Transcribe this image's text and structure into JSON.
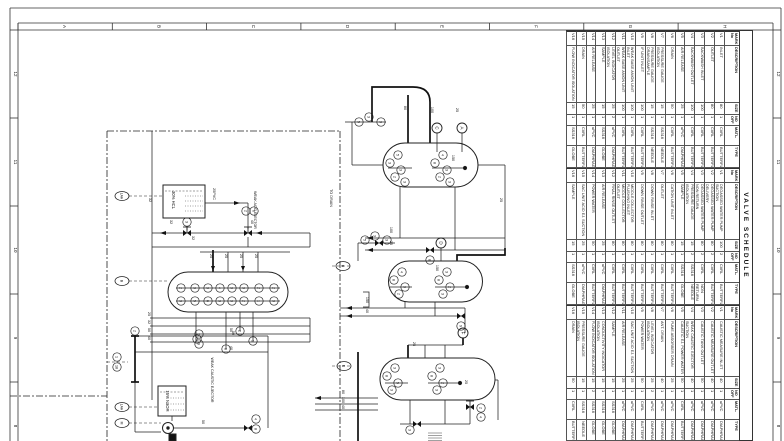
{
  "sheet": {
    "grid_letters": [
      "A",
      "B",
      "C",
      "D",
      "E",
      "F",
      "G",
      "H"
    ],
    "grid_numbers": [
      "12",
      "11",
      "10",
      "9",
      "8"
    ],
    "line_color": "#333333",
    "paper_color": "#ffffff"
  },
  "valve_schedule": {
    "title": "VALVE SCHEDULE",
    "columns": [
      "MARK No",
      "DESCRIPTION",
      "SIZE",
      "NO OFF",
      "MATL.",
      "TYPE"
    ],
    "groups": [
      {
        "rows": [
          {
            "mark": "V1",
            "desc": "INLET",
            "size": "80",
            "no": "1",
            "matl": "CI/RL",
            "type": "BUTTERFLY"
          },
          {
            "mark": "V2",
            "desc": "OUTLET",
            "size": "80",
            "no": "1",
            "matl": "CI/RL",
            "type": "BUTTERFLY"
          },
          {
            "mark": "V3",
            "desc": "BACKWASH INLET",
            "size": "100",
            "no": "1",
            "matl": "CI/RL",
            "type": "BUTTERFLY"
          },
          {
            "mark": "V4",
            "desc": "BACKWASH OUTLET",
            "size": "100",
            "no": "1",
            "matl": "CI/RL",
            "type": "BUTTERFLY"
          },
          {
            "mark": "V5",
            "desc": "AIR RELEASE",
            "size": "25",
            "no": "1",
            "matl": "uPVC",
            "type": "DIAPHRAGM"
          },
          {
            "mark": "V6",
            "desc": "DRAIN",
            "size": "50",
            "no": "1",
            "matl": "CI/RL",
            "type": "BUTTERFLY"
          },
          {
            "mark": "V7",
            "desc": "PRESSURE GAUGE ISOLATION",
            "size": "15",
            "no": "1",
            "matl": "SS316",
            "type": "NEEDLE"
          },
          {
            "mark": "V8",
            "desc": "PRESSURE GAUGE DRAIN/SAMPLE",
            "size": "15",
            "no": "1",
            "matl": "SS316",
            "type": "NEEDLE"
          },
          {
            "mark": "V9",
            "desc": "IF UNIT INLET",
            "size": "100",
            "no": "1",
            "matl": "CI/RL",
            "type": "BUTTERFLY"
          },
          {
            "mark": "V10",
            "desc": "WEAK BASE ANION UNIT INLET",
            "size": "100",
            "no": "1",
            "matl": "CI/RL",
            "type": "BUTTERFLY"
          },
          {
            "mark": "V11",
            "desc": "WEAK BASE ANION UNIT OUTLET",
            "size": "100",
            "no": "1",
            "matl": "CI/RL",
            "type": "BUTTERFLY"
          },
          {
            "mark": "V12",
            "desc": "LEVEL INDICATOR ISOLATION",
            "size": "25",
            "no": "2",
            "matl": "uPVC",
            "type": "DIAPHRAGM"
          },
          {
            "mark": "V13",
            "desc": "SAMPLE",
            "size": "15",
            "no": "1",
            "matl": "SS316",
            "type": "GLOBE"
          },
          {
            "mark": "V14",
            "desc": "AIR RELEASE",
            "size": "25",
            "no": "1",
            "matl": "uPVC",
            "type": "DIAPHRAGM"
          },
          {
            "mark": "V15",
            "desc": "DRAIN",
            "size": "50",
            "no": "1",
            "matl": "CI/RL",
            "type": "BUTTERFLY"
          },
          {
            "mark": "V16",
            "desc": "FLOW INDICATOR ISOLATION",
            "size": "15",
            "no": "1",
            "matl": "SS316",
            "type": "GLOBE"
          }
        ]
      },
      {
        "rows": [
          {
            "mark": "V1",
            "desc": "DEGASSED WATER PUMP SUCTION",
            "size": "100",
            "no": "2",
            "matl": "CI/RL",
            "type": "BUTTERFLY"
          },
          {
            "mark": "V2",
            "desc": "DEGASSED WATER PUMP DELIVERY",
            "size": "80",
            "no": "2",
            "matl": "CI/RL",
            "type": "BUTTERFLY"
          },
          {
            "mark": "V3",
            "desc": "DEGASSED WATER PUMP NON RETURN",
            "size": "80",
            "no": "2",
            "matl": "CI/RL",
            "type": "NON RETURN"
          },
          {
            "mark": "V4",
            "desc": "PRESSURE GAUGE ISOLATION",
            "size": "15",
            "no": "2",
            "matl": "SS316",
            "type": "NEEDLE"
          },
          {
            "mark": "V5",
            "desc": "SAMPLE",
            "size": "15",
            "no": "1",
            "matl": "SS316",
            "type": "GLOBE"
          },
          {
            "mark": "V6",
            "desc": "CATION UNIT INLET",
            "size": "80",
            "no": "1",
            "matl": "CI/RL",
            "type": "BUTTERFLY"
          },
          {
            "mark": "V7",
            "desc": "OUTLET",
            "size": "80",
            "no": "1",
            "matl": "CI/RL",
            "type": "BUTTERFLY"
          },
          {
            "mark": "V8",
            "desc": "DOWN RINSE INLET",
            "size": "80",
            "no": "1",
            "matl": "CI/RL",
            "type": "BUTTERFLY"
          },
          {
            "mark": "V9",
            "desc": "DOWN RINSE OUTLET",
            "size": "80",
            "no": "1",
            "matl": "CI/RL",
            "type": "BUTTERFLY"
          },
          {
            "mark": "V10",
            "desc": "MIDDLE COLLECTOR FLUSHING INLET",
            "size": "80",
            "no": "1",
            "matl": "CI/RL",
            "type": "BUTTERFLY"
          },
          {
            "mark": "V11",
            "desc": "MIDDLE COLLECTOR OUTLET",
            "size": "80",
            "no": "1",
            "matl": "CI/RL",
            "type": "BUTTERFLY"
          },
          {
            "mark": "V12",
            "desc": "FINAL RINSE OUTLET",
            "size": "80",
            "no": "1",
            "matl": "CI/RL",
            "type": "BUTTERFLY"
          },
          {
            "mark": "V13",
            "desc": "AIR RELEASE",
            "size": "25",
            "no": "1",
            "matl": "uPVC",
            "type": "DIAPHRAGM"
          },
          {
            "mark": "V14",
            "desc": "POWER WATER",
            "size": "50",
            "no": "1",
            "matl": "CI/RL",
            "type": "BUTTERFLY"
          },
          {
            "mark": "V15",
            "desc": "SAC UNIT ACID EJ. SUCTION",
            "size": "25",
            "no": "1",
            "matl": "uPVC",
            "type": "DIAPHRAGM"
          },
          {
            "mark": "V16",
            "desc": "SAMPLE",
            "size": "15",
            "no": "1",
            "matl": "SS316",
            "type": "GLOBE"
          }
        ]
      },
      {
        "rows": [
          {
            "mark": "V1",
            "desc": "CAUSTIC MEASURE INLET",
            "size": "40",
            "no": "1",
            "matl": "uPVC",
            "type": "DIAPHRAGM"
          },
          {
            "mark": "V2",
            "desc": "CAUSTIC MEASURE OUTLET",
            "size": "40",
            "no": "1",
            "matl": "uPVC",
            "type": "DIAPHRAGM"
          },
          {
            "mark": "V3",
            "desc": "CAUSTIC TANK OUTLET",
            "size": "50",
            "no": "1",
            "matl": "uPVC",
            "type": "DIAPHRAGM"
          },
          {
            "mark": "V4",
            "desc": "WEAK CAUSTIC EJECTOR SUCTION",
            "size": "40",
            "no": "1",
            "matl": "uPVC",
            "type": "DIAPHRAGM"
          },
          {
            "mark": "V5",
            "desc": "CAUSTIC EJ. POWER WATER",
            "size": "50",
            "no": "1",
            "matl": "CI/RL",
            "type": "BUTTERFLY"
          },
          {
            "mark": "V6",
            "desc": "FUME ABSORBER DRAIN",
            "size": "25",
            "no": "1",
            "matl": "uPVC",
            "type": "DIAPHRAGM"
          },
          {
            "mark": "V7",
            "desc": "ANT. DRAIN",
            "size": "40",
            "no": "1",
            "matl": "uPVC",
            "type": "DIAPHRAGM"
          },
          {
            "mark": "V8",
            "desc": "LEVEL INDICATOR ISOLATION",
            "size": "25",
            "no": "2",
            "matl": "uPVC",
            "type": "DIAPHRAGM"
          },
          {
            "mark": "V9",
            "desc": "POWER WATER",
            "size": "50",
            "no": "1",
            "matl": "CI/RL",
            "type": "BUTTERFLY"
          },
          {
            "mark": "V10",
            "desc": "SAC UNIT ACID EJ. SUCTION",
            "size": "25",
            "no": "1",
            "matl": "uPVC",
            "type": "DIAPHRAGM"
          },
          {
            "mark": "V11",
            "desc": "AIR RELEASE",
            "size": "25",
            "no": "1",
            "matl": "uPVC",
            "type": "DIAPHRAGM"
          },
          {
            "mark": "V12",
            "desc": "SAMPLE",
            "size": "15",
            "no": "1",
            "matl": "SS316",
            "type": "GLOBE"
          },
          {
            "mark": "V13",
            "desc": "CONDUCTIVITY INDICATOR ISOLATION",
            "size": "15",
            "no": "1",
            "matl": "SS316",
            "type": "GLOBE"
          },
          {
            "mark": "V14",
            "desc": "FLOW INDICATOR ISOLATION",
            "size": "15",
            "no": "2",
            "matl": "SS316",
            "type": "GLOBE"
          },
          {
            "mark": "V15",
            "desc": "PRESSURE GAUGE ISOLATION",
            "size": "15",
            "no": "1",
            "matl": "SS316",
            "type": "NEEDLE"
          },
          {
            "mark": "V16",
            "desc": "DRAIN",
            "size": "50",
            "no": "1",
            "matl": "CI/RL",
            "type": "BUTTERFLY"
          }
        ]
      }
    ]
  },
  "diagram": {
    "equipment": {
      "acid_tank": "30% HCL",
      "caustic_tank": "15% NaOH",
      "acid_ejector": "WEAK ACID EJECTOR",
      "caustic_ejector": "WEAK CAUSTIC EJECTOR",
      "to_drain": "TO DRAIN",
      "scope_note": "SCOPE OF CONTRACT"
    },
    "connectors": [
      {
        "x": 437,
        "y": 128,
        "t": "C"
      },
      {
        "x": 462,
        "y": 128,
        "t": "A"
      },
      {
        "x": 441,
        "y": 243,
        "t": "D"
      },
      {
        "x": 463,
        "y": 333,
        "t": "F"
      }
    ],
    "ovals": [
      {
        "x": 122,
        "y": 196,
        "t": "LAH"
      },
      {
        "x": 122,
        "y": 281,
        "t": "B"
      },
      {
        "x": 343,
        "y": 266,
        "t": "B"
      },
      {
        "x": 344,
        "y": 366,
        "t": "E"
      },
      {
        "x": 122,
        "y": 407,
        "t": "LAH"
      },
      {
        "x": 122,
        "y": 423,
        "t": "M"
      }
    ],
    "pipe_labels": [
      {
        "x": 213,
        "y": 194,
        "t": "25PVC"
      },
      {
        "x": 170,
        "y": 222,
        "t": "32"
      },
      {
        "x": 251,
        "y": 222,
        "t": "40"
      },
      {
        "x": 192,
        "y": 238,
        "t": "32"
      },
      {
        "x": 210,
        "y": 256,
        "t": "25"
      },
      {
        "x": 225,
        "y": 256,
        "t": "25"
      },
      {
        "x": 240,
        "y": 256,
        "t": "25"
      },
      {
        "x": 255,
        "y": 256,
        "t": "25"
      },
      {
        "x": 148,
        "y": 314,
        "t": "25"
      },
      {
        "x": 148,
        "y": 322,
        "t": "32"
      },
      {
        "x": 148,
        "y": 330,
        "t": "50"
      },
      {
        "x": 148,
        "y": 338,
        "t": "40"
      },
      {
        "x": 230,
        "y": 330,
        "t": "50"
      },
      {
        "x": 230,
        "y": 348,
        "t": "40"
      },
      {
        "x": 202,
        "y": 422,
        "t": "50"
      },
      {
        "x": 390,
        "y": 230,
        "t": "100"
      },
      {
        "x": 390,
        "y": 243,
        "t": "25"
      },
      {
        "x": 431,
        "y": 110,
        "t": "100"
      },
      {
        "x": 456,
        "y": 110,
        "t": "25"
      },
      {
        "x": 404,
        "y": 108,
        "t": "80"
      },
      {
        "x": 500,
        "y": 200,
        "t": "25"
      },
      {
        "x": 452,
        "y": 158,
        "t": "150"
      },
      {
        "x": 436,
        "y": 268,
        "t": "150"
      },
      {
        "x": 366,
        "y": 300,
        "t": "150"
      },
      {
        "x": 366,
        "y": 311,
        "t": "40"
      },
      {
        "x": 342,
        "y": 392,
        "t": "80"
      },
      {
        "x": 342,
        "y": 400,
        "t": "100"
      },
      {
        "x": 342,
        "y": 407,
        "t": "40"
      },
      {
        "x": 413,
        "y": 344,
        "t": "25"
      },
      {
        "x": 232,
        "y": 333,
        "t": "50"
      },
      {
        "x": 465,
        "y": 382,
        "t": "25"
      },
      {
        "x": 149,
        "y": 200,
        "t": "32"
      }
    ],
    "valve_tags": [
      {
        "x": 187,
        "y": 222,
        "t": "3"
      },
      {
        "x": 246,
        "y": 211,
        "t": "2"
      },
      {
        "x": 254,
        "y": 211,
        "t": "6"
      },
      {
        "x": 117,
        "y": 357,
        "t": "1"
      },
      {
        "x": 117,
        "y": 367,
        "t": "18"
      },
      {
        "x": 199,
        "y": 334,
        "t": "7"
      },
      {
        "x": 199,
        "y": 344,
        "t": "9"
      },
      {
        "x": 256,
        "y": 419,
        "t": "4"
      },
      {
        "x": 256,
        "y": 429,
        "t": "8"
      },
      {
        "x": 135,
        "y": 331,
        "t": "2"
      },
      {
        "x": 197,
        "y": 339,
        "t": "5"
      },
      {
        "x": 240,
        "y": 331,
        "t": "2"
      },
      {
        "x": 253,
        "y": 341,
        "t": "3"
      },
      {
        "x": 226,
        "y": 349,
        "t": "8"
      },
      {
        "x": 181,
        "y": 288,
        "t": "2"
      },
      {
        "x": 195,
        "y": 288,
        "t": "3"
      },
      {
        "x": 208,
        "y": 288,
        "t": "3"
      },
      {
        "x": 220,
        "y": 288,
        "t": "4"
      },
      {
        "x": 232,
        "y": 288,
        "t": "3"
      },
      {
        "x": 244,
        "y": 288,
        "t": "3"
      },
      {
        "x": 259,
        "y": 288,
        "t": "2"
      },
      {
        "x": 274,
        "y": 288,
        "t": "2"
      },
      {
        "x": 181,
        "y": 301,
        "t": "3"
      },
      {
        "x": 195,
        "y": 301,
        "t": "5"
      },
      {
        "x": 208,
        "y": 301,
        "t": "6"
      },
      {
        "x": 220,
        "y": 301,
        "t": "3"
      },
      {
        "x": 232,
        "y": 301,
        "t": "3"
      },
      {
        "x": 244,
        "y": 301,
        "t": "2"
      },
      {
        "x": 259,
        "y": 301,
        "t": "1"
      },
      {
        "x": 274,
        "y": 301,
        "t": "3"
      },
      {
        "x": 359,
        "y": 122,
        "t": "5"
      },
      {
        "x": 369,
        "y": 117,
        "t": "3"
      },
      {
        "x": 381,
        "y": 122,
        "t": "3"
      },
      {
        "x": 365,
        "y": 240,
        "t": "5"
      },
      {
        "x": 375,
        "y": 236,
        "t": "3"
      },
      {
        "x": 387,
        "y": 240,
        "t": "3"
      },
      {
        "x": 398,
        "y": 155,
        "t": "5"
      },
      {
        "x": 390,
        "y": 163,
        "t": "3"
      },
      {
        "x": 401,
        "y": 170,
        "t": "3"
      },
      {
        "x": 395,
        "y": 177,
        "t": "2"
      },
      {
        "x": 405,
        "y": 182,
        "t": "3"
      },
      {
        "x": 443,
        "y": 155,
        "t": "4"
      },
      {
        "x": 435,
        "y": 163,
        "t": "8"
      },
      {
        "x": 447,
        "y": 170,
        "t": "3"
      },
      {
        "x": 440,
        "y": 177,
        "t": "2"
      },
      {
        "x": 450,
        "y": 182,
        "t": "3"
      },
      {
        "x": 402,
        "y": 272,
        "t": "4"
      },
      {
        "x": 394,
        "y": 280,
        "t": "8"
      },
      {
        "x": 405,
        "y": 287,
        "t": "3"
      },
      {
        "x": 399,
        "y": 294,
        "t": "2"
      },
      {
        "x": 447,
        "y": 272,
        "t": "3"
      },
      {
        "x": 439,
        "y": 280,
        "t": "8"
      },
      {
        "x": 450,
        "y": 287,
        "t": "2"
      },
      {
        "x": 443,
        "y": 294,
        "t": "3"
      },
      {
        "x": 395,
        "y": 368,
        "t": "3"
      },
      {
        "x": 387,
        "y": 376,
        "t": "8"
      },
      {
        "x": 398,
        "y": 383,
        "t": "5"
      },
      {
        "x": 392,
        "y": 390,
        "t": "3"
      },
      {
        "x": 440,
        "y": 368,
        "t": "3"
      },
      {
        "x": 432,
        "y": 376,
        "t": "8"
      },
      {
        "x": 443,
        "y": 383,
        "t": "2"
      },
      {
        "x": 437,
        "y": 390,
        "t": "3"
      },
      {
        "x": 410,
        "y": 430,
        "t": "3"
      },
      {
        "x": 481,
        "y": 408,
        "t": "2"
      },
      {
        "x": 481,
        "y": 417,
        "t": "4"
      },
      {
        "x": 430,
        "y": 260,
        "t": "8"
      },
      {
        "x": 461,
        "y": 326,
        "t": "9"
      }
    ]
  }
}
